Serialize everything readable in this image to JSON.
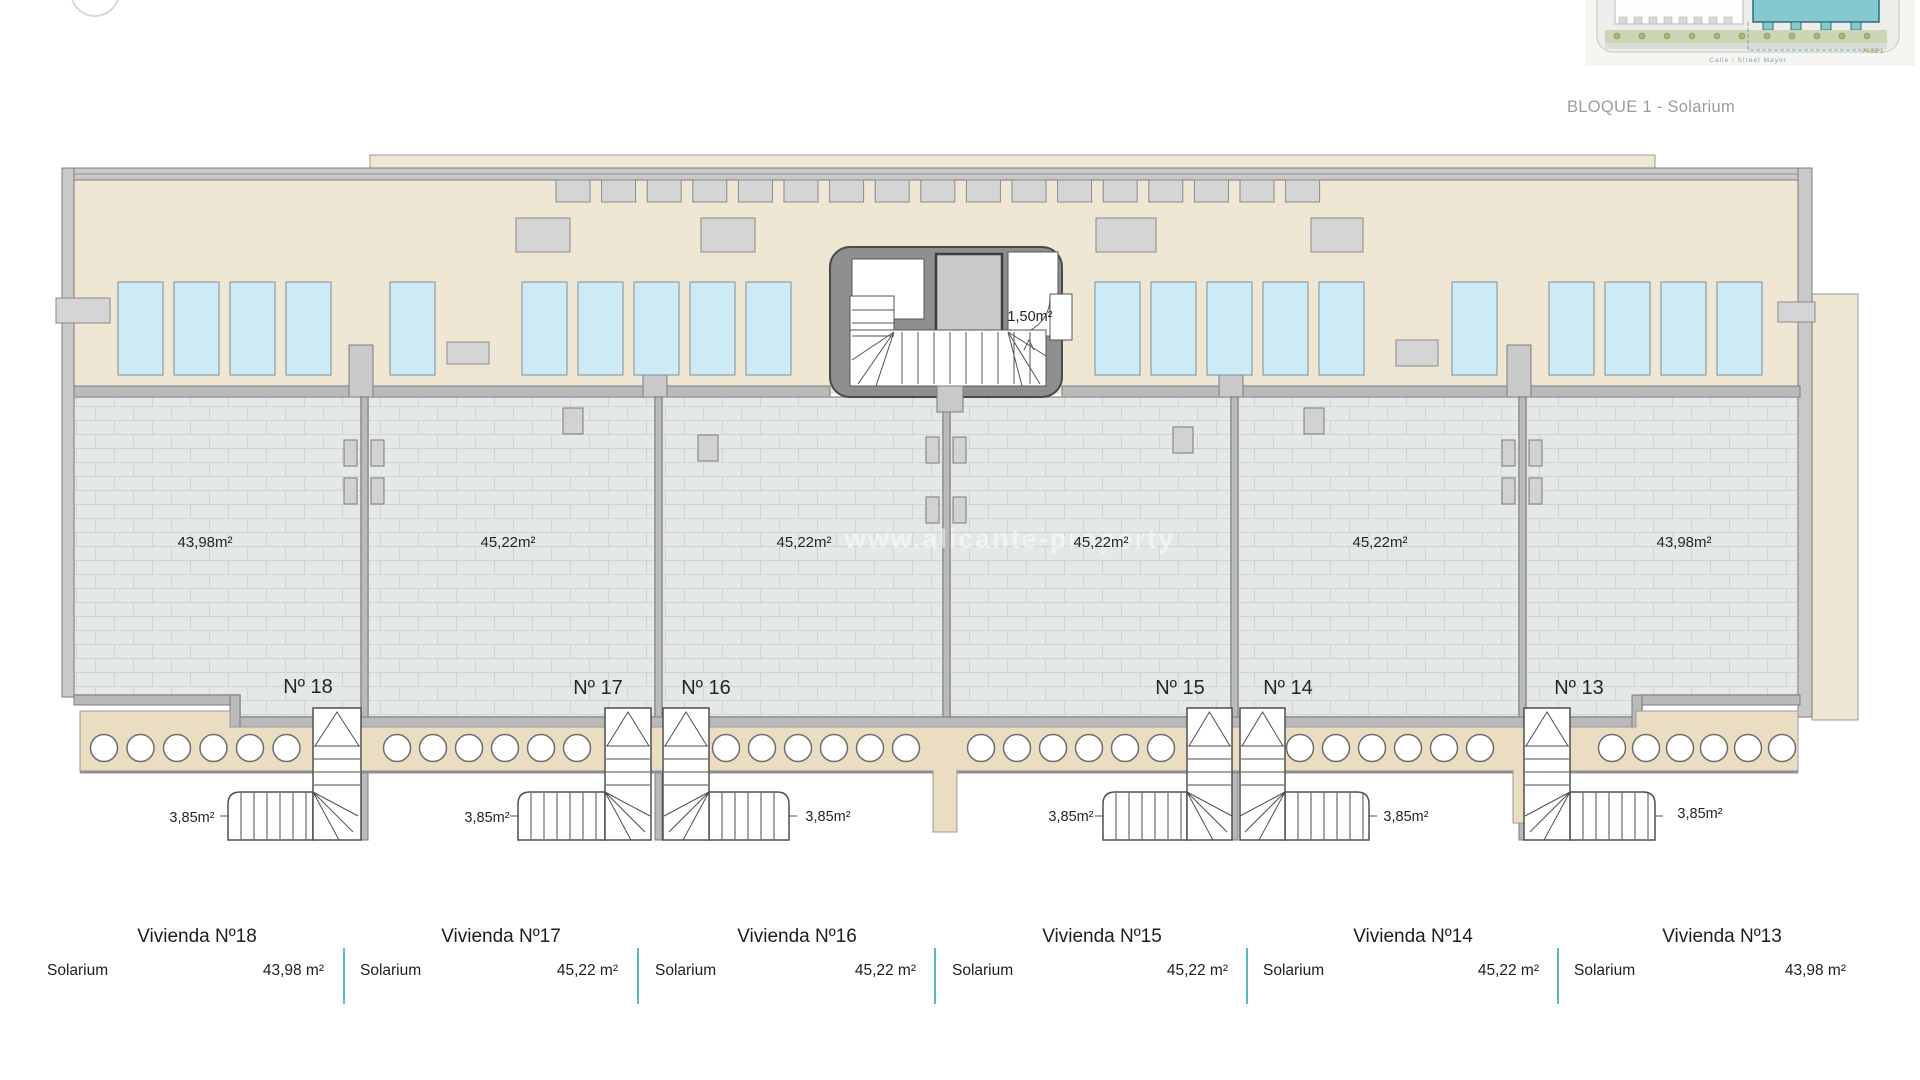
{
  "page": {
    "background": "#ffffff"
  },
  "inset": {
    "caption": "BLOQUE 1 - Solarium",
    "street_label": "Calle / Street Mayor",
    "phase_label": "FASE 1",
    "highlight_color": "#85c8cf"
  },
  "watermark": "www.alicante-property",
  "plan": {
    "stairwell_area_label": "1,50m²",
    "units": [
      {
        "number": "Nº 18",
        "solarium_area": "43,98m²",
        "stair_area": "3,85m²"
      },
      {
        "number": "Nº 17",
        "solarium_area": "45,22m²",
        "stair_area": "3,85m²"
      },
      {
        "number": "Nº 16",
        "solarium_area": "45,22m²",
        "stair_area": "3,85m²"
      },
      {
        "number": "Nº 15",
        "solarium_area": "45,22m²",
        "stair_area": "3,85m²"
      },
      {
        "number": "Nº 14",
        "solarium_area": "45,22m²",
        "stair_area": "3,85m²"
      },
      {
        "number": "Nº 13",
        "solarium_area": "43,98m²",
        "stair_area": "3,85m²"
      }
    ]
  },
  "legend": {
    "divider_color": "#5fb8bb",
    "sections": [
      {
        "title": "Vivienda Nº18",
        "room": "Solarium",
        "value": "43,98 m²"
      },
      {
        "title": "Vivienda Nº17",
        "room": "Solarium",
        "value": "45,22 m²"
      },
      {
        "title": "Vivienda Nº16",
        "room": "Solarium",
        "value": "45,22 m²"
      },
      {
        "title": "Vivienda Nº15",
        "room": "Solarium",
        "value": "45,22 m²"
      },
      {
        "title": "Vivienda Nº14",
        "room": "Solarium",
        "value": "45,22 m²"
      },
      {
        "title": "Vivienda Nº13",
        "room": "Solarium",
        "value": "43,98 m²"
      }
    ]
  },
  "colors": {
    "deck": "#efe7d3",
    "walkway": "#ebddc1",
    "tile": "#e4e9e6",
    "tile_line": "#ced6d3",
    "wall": "#c9c9c9",
    "wall_dark": "#bababa",
    "wall_stroke": "#7c7c7c",
    "stairwell": "#8f8f8f",
    "panel_blue": "#cdeaf7",
    "unit_gray": "#d5d5d5"
  }
}
